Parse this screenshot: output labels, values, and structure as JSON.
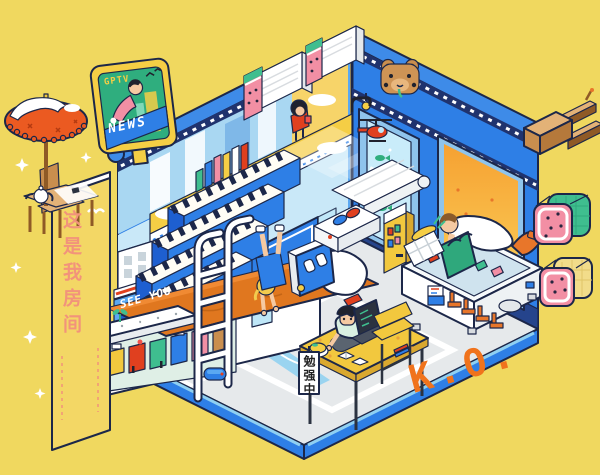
{
  "texts": {
    "billboard_brand": "GPTV",
    "billboard_banner": "NEWS",
    "wall_banner": "这是我房间",
    "see_you": "SEE YOU",
    "temperature": "40°L",
    "studying_sign": "勉强中",
    "ko": "K.O."
  },
  "palette": {
    "background": "#F0D85F",
    "wall_blue": "#2E7FE6",
    "wall_pale_blue": "#C9E8F8",
    "navy_outline": "#1C2749",
    "zipper_navy": "#20336E",
    "parasol_orange": "#EB5A21",
    "mattress_orange": "#E0771F",
    "ko_orange": "#F0731C",
    "sun_red": "#F2500F",
    "accent_yellow": "#F2C83E",
    "screen_teal": "#2FAE7E",
    "watermelon_pink": "#F28FA4",
    "watermelon_green": "#3FBE8F",
    "wood_brown": "#C98E4E",
    "banner_text_color": "#F2937B"
  },
  "objects": [
    "parasol",
    "tea-table",
    "tea-chair",
    "teapot",
    "billboard-tv",
    "piano-stairs",
    "loft-books",
    "loft-girl",
    "glass-platform",
    "air-conditioner",
    "watermelon-towel",
    "bear-controller",
    "aquarium-window",
    "toy-helicopter",
    "sunset-window",
    "climbing-man",
    "freezer-chest",
    "grocery-basket",
    "tote-bag",
    "waiting-seats",
    "bed",
    "bed-ladder",
    "under-bed-diorama",
    "handstand-girl",
    "hands-monitor",
    "awning",
    "slipper-pod",
    "vending-machine",
    "robot-vacuum",
    "study-desk",
    "studying-boy",
    "laptop",
    "desk-chair",
    "wooden-plug",
    "watermelon-toast-green",
    "watermelon-toast-yellow"
  ]
}
